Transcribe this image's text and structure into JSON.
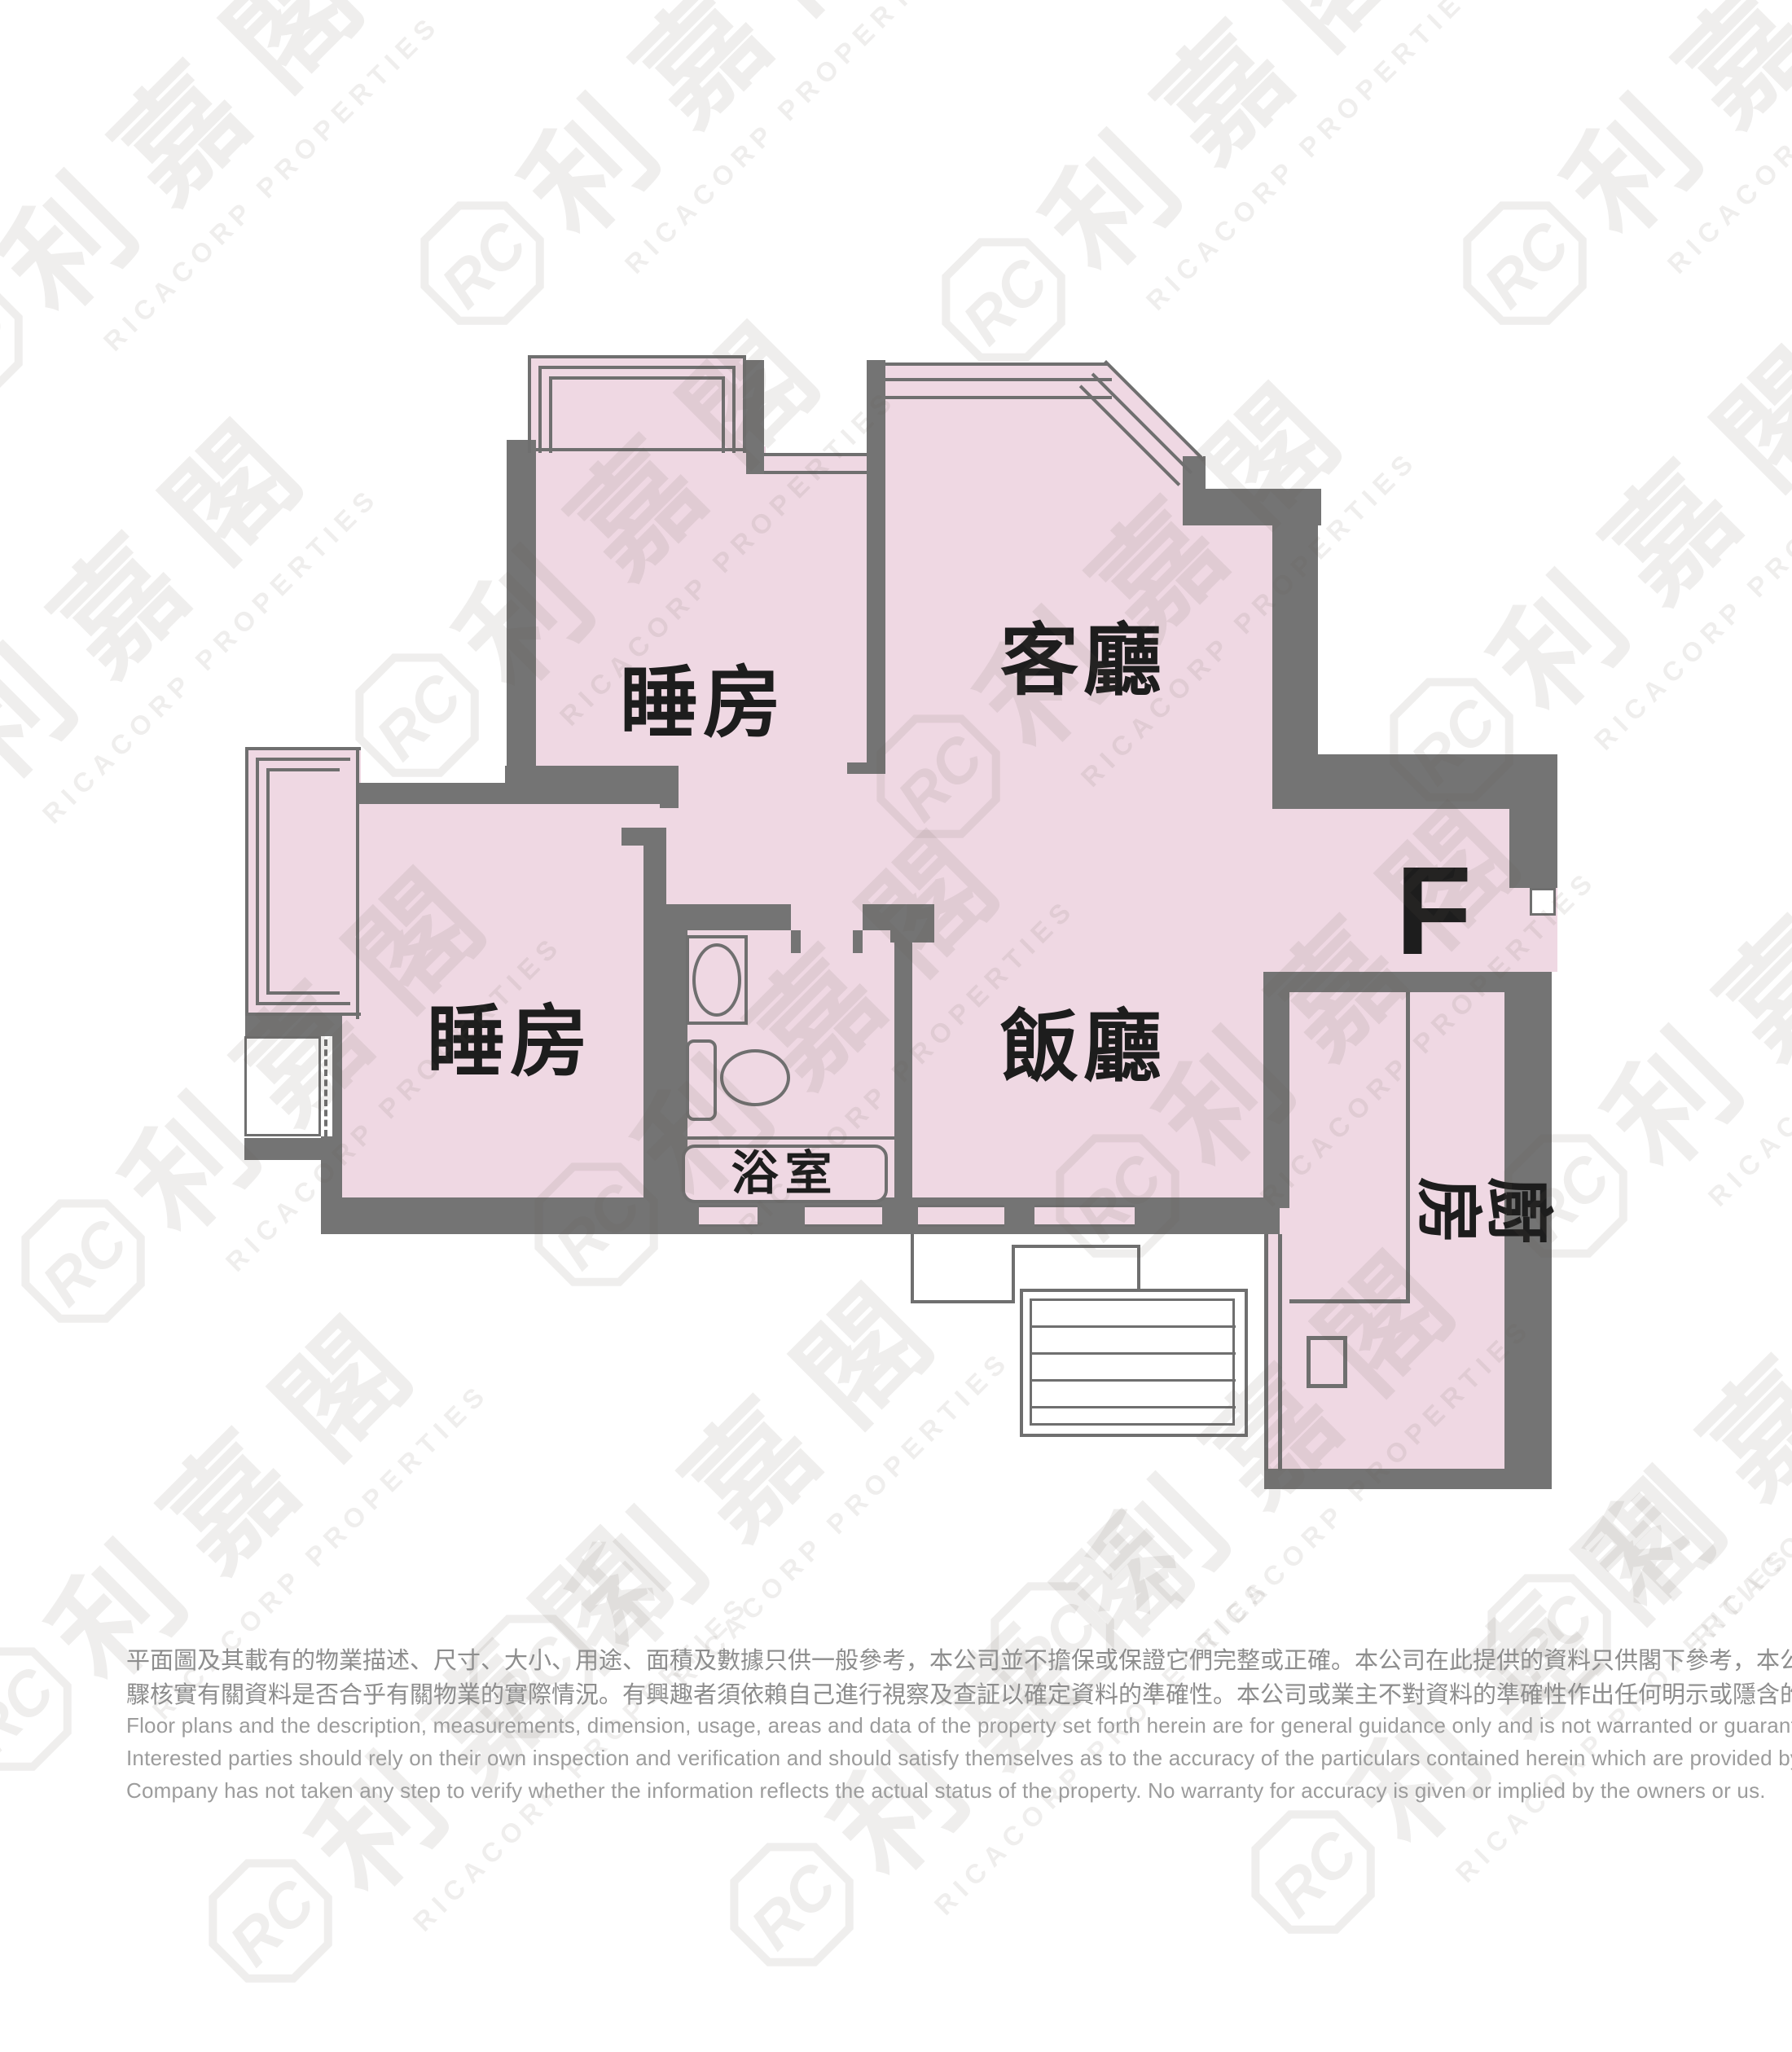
{
  "floor_plan": {
    "unit_label": "F",
    "rooms": [
      {
        "id": "bedroom-1",
        "label": "睡房"
      },
      {
        "id": "living-room",
        "label": "客廳"
      },
      {
        "id": "bedroom-2",
        "label": "睡房"
      },
      {
        "id": "dining-room",
        "label": "飯廳"
      },
      {
        "id": "bathroom",
        "label": "浴室"
      },
      {
        "id": "kitchen",
        "label": "廚房"
      }
    ]
  },
  "watermark": {
    "logo_monogram": "RC",
    "name_zh": "利嘉閣",
    "name_en": "RICACORP PROPERTIES"
  },
  "disclaimer": {
    "zh_lines": [
      "平面圖及其載有的物業描述、尺寸、大小、用途、面積及數據只供一般參考，本公司並不擔保或保證它們完整或正確。本公司在此提供的資料只供閣下參考，本公司並無採取任何步",
      "驟核實有關資料是否合乎有關物業的實際情況。有興趣者須依賴自己進行視察及查証以確定資料的準確性。本公司或業主不對資料的準確性作出任何明示或隱含的保證。"
    ],
    "en_lines": [
      "Floor plans and the description, measurements, dimension, usage, areas and data of the property set forth herein are for general guidance only and is not warranted or guaranteed to be complete or correct.",
      "Interested parties should rely on their own inspection and verification and should satisfy themselves as to the accuracy of the particulars contained herein which are provided by us for information only.  Our",
      "Company has not taken any step to verify whether the information reflects the actual status of the property.  No warranty for accuracy is given or implied by the owners or us."
    ]
  },
  "colors": {
    "room_fill": "#EFD8E3",
    "wall": "#747474",
    "label_text": "#1D1D1D"
  }
}
